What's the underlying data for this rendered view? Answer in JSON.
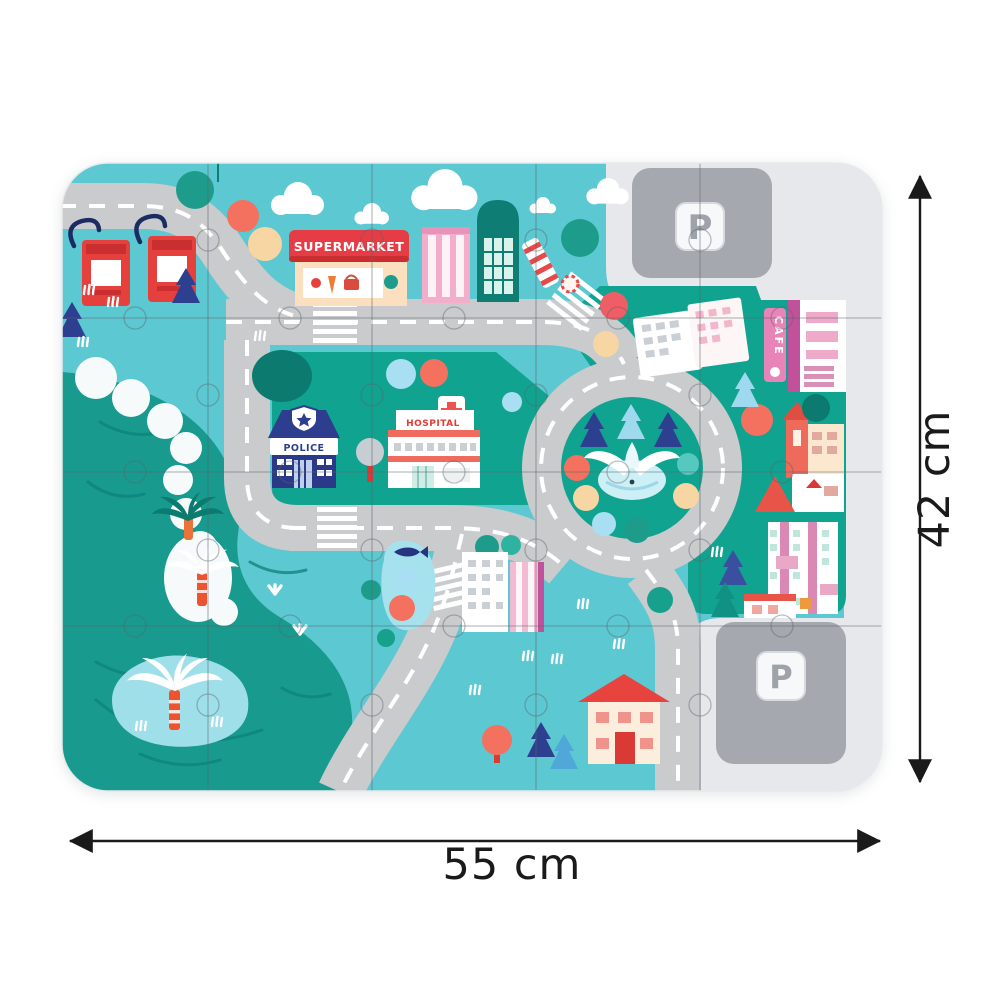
{
  "annotation": {
    "width_label": "55 cm",
    "height_label": "42 cm"
  },
  "mat_labels": {
    "supermarket": "SUPERMARKET",
    "police": "POLICE",
    "hospital": "HOSPITAL",
    "cafe": "CAFE",
    "parking_top": "P",
    "parking_bottom": "P"
  },
  "palette": {
    "aqua": "#5CC8D2",
    "water": "#189A8E",
    "park_green": "#10A390",
    "road": "#C9CBCD",
    "road_line": "#FFFFFF",
    "parking_light": "#E6E8EC",
    "parking_pad": "#A5A8AF",
    "sign_red": "#E63C46",
    "police_navy": "#2E3E8E",
    "hospital_red": "#EF5350",
    "pink": "#F2A7C3",
    "cream": "#FBE3C2",
    "coral": "#F4715F",
    "peach": "#F8D6A3",
    "light_blue": "#A9DFF2",
    "dimension_color": "#1A1A1A"
  }
}
